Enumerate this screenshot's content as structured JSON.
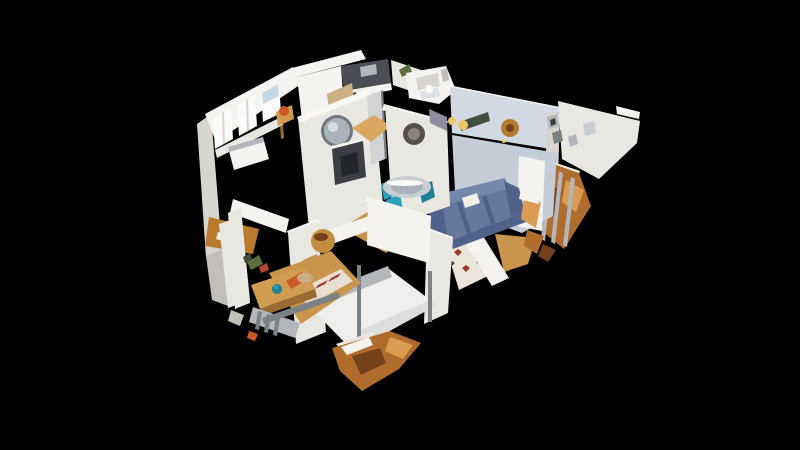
{
  "scene": {
    "description": "3D dollhouse cutaway view of a scanned apartment floating on a black background (virtual-tour dollhouse mode, no UI chrome)",
    "background": "#000000",
    "palette": {
      "bg": "#000000",
      "wall": "#e9e7e2",
      "wall_bright": "#f4f3ef",
      "wall_top": "#f8f7f4",
      "wall_dim": "#d8d5cf",
      "wall_shadow": "#c2bfb9",
      "wall_blue": "#c5cdd9",
      "wall_blue_light": "#d3d9e2",
      "purple": "#8d8d9f",
      "floor": "#c9944b",
      "floor_light": "#d9a75f",
      "floor_dark": "#b97a2f",
      "kitchen_dark": "#4a4d53",
      "cabinet_tan": "#ccb083",
      "door_gray": "#d2d3d4",
      "mirror": "#aab3bb",
      "mirror_ring": "#70787f",
      "mirror_light": "#d8dde1",
      "medallion": "#57504a",
      "medallion_light": "#8d8478",
      "fireplace": "#3b3e44",
      "fireplace_inner": "#22252a",
      "sofa": "#66789d",
      "sofa_light": "#7587ac",
      "sofa_dark": "#50628a",
      "pillow": "#f2efe7",
      "rug": "#ebe5d9",
      "rug_red": "#a03a30",
      "rug_dark": "#47403c",
      "runner": "#e8dfd2",
      "chair_teal": "#2aa2ba",
      "chair_teal_dark": "#1f7f94",
      "teal_deep": "#1f8291",
      "table_glass": "#c9ced3",
      "table_glass_dark": "#a9b0b7",
      "green_dark": "#41503c",
      "plant_green": "#5c703f",
      "red_item": "#b5452e",
      "gold": "#b57c2f",
      "gold_table": "#c28d3f",
      "gold_light": "#edc76a",
      "orange": "#b06c2c",
      "orange_dark": "#74421a",
      "orange_light": "#d99c52",
      "orange_accent": "#cc5a28",
      "desk_wood": "#d09c52",
      "desk_wood_dark": "#9a6a33",
      "metal": "#b3b6ba",
      "metal_dark": "#7c8186",
      "bed": "#eff0ee",
      "bed_shade": "#dcdedc",
      "sky": "#c6d8e3",
      "window": "#fbfbf9",
      "tile": "#dde2e6"
    }
  }
}
